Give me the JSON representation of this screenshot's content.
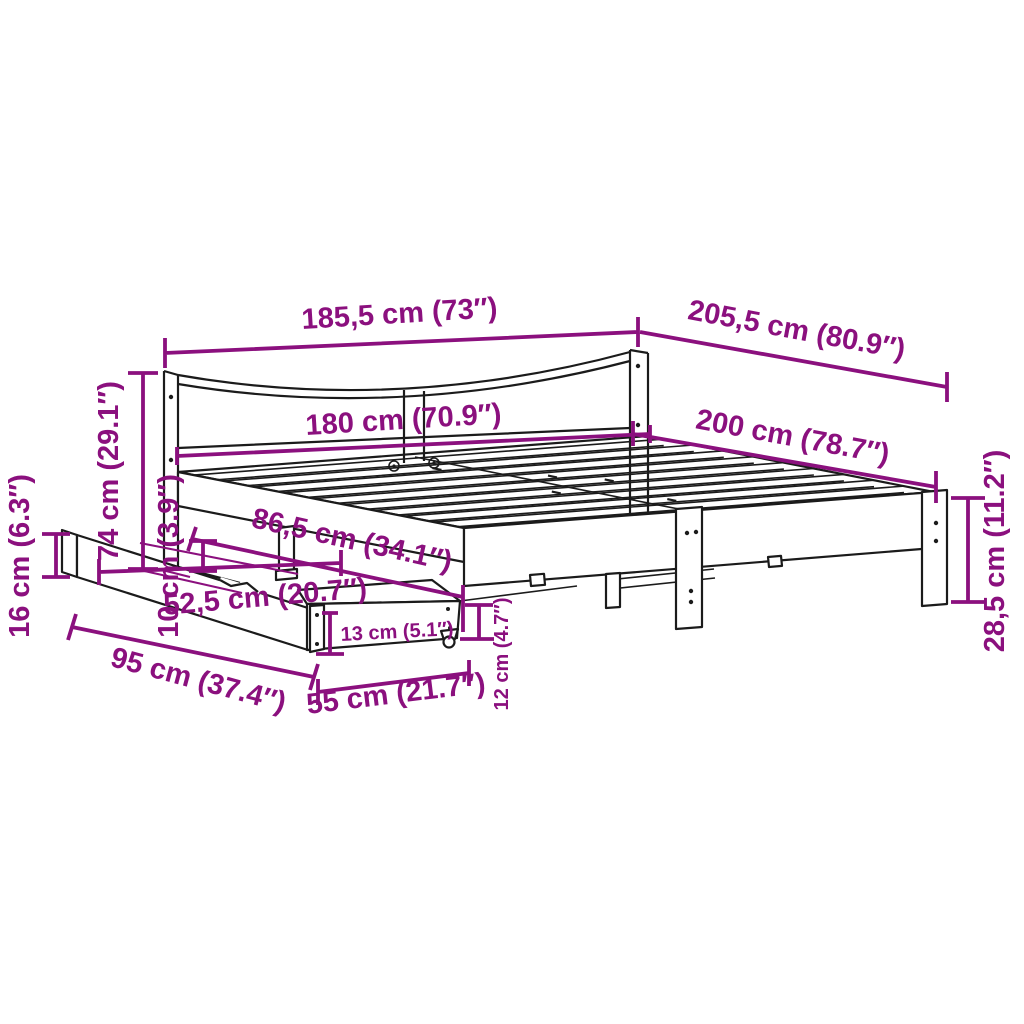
{
  "diagram": {
    "colors": {
      "dimension_accent": "#8B107E",
      "artwork_line": "#1b1b1b",
      "background": "#ffffff"
    },
    "labels": {
      "d185_5": "185,5 cm (73″)",
      "d205_5": "205,5 cm (80.9″)",
      "d180": "180 cm (70.9″)",
      "d200": "200 cm (78.7″)",
      "d74": "74 cm (29.1″)",
      "d16": "16 cm (6.3″)",
      "d10": "10 cm (3.9″)",
      "d86_5": "86,5 cm (34.1″)",
      "d52_5": "52,5 cm (20.7″)",
      "d13": "13 cm (5.1″)",
      "d95": "95 cm (37.4″)",
      "d55": "55 cm (21.7″)",
      "d12": "12 cm (4.7″)",
      "d28_5": "28,5 cm (11.2″)"
    }
  }
}
